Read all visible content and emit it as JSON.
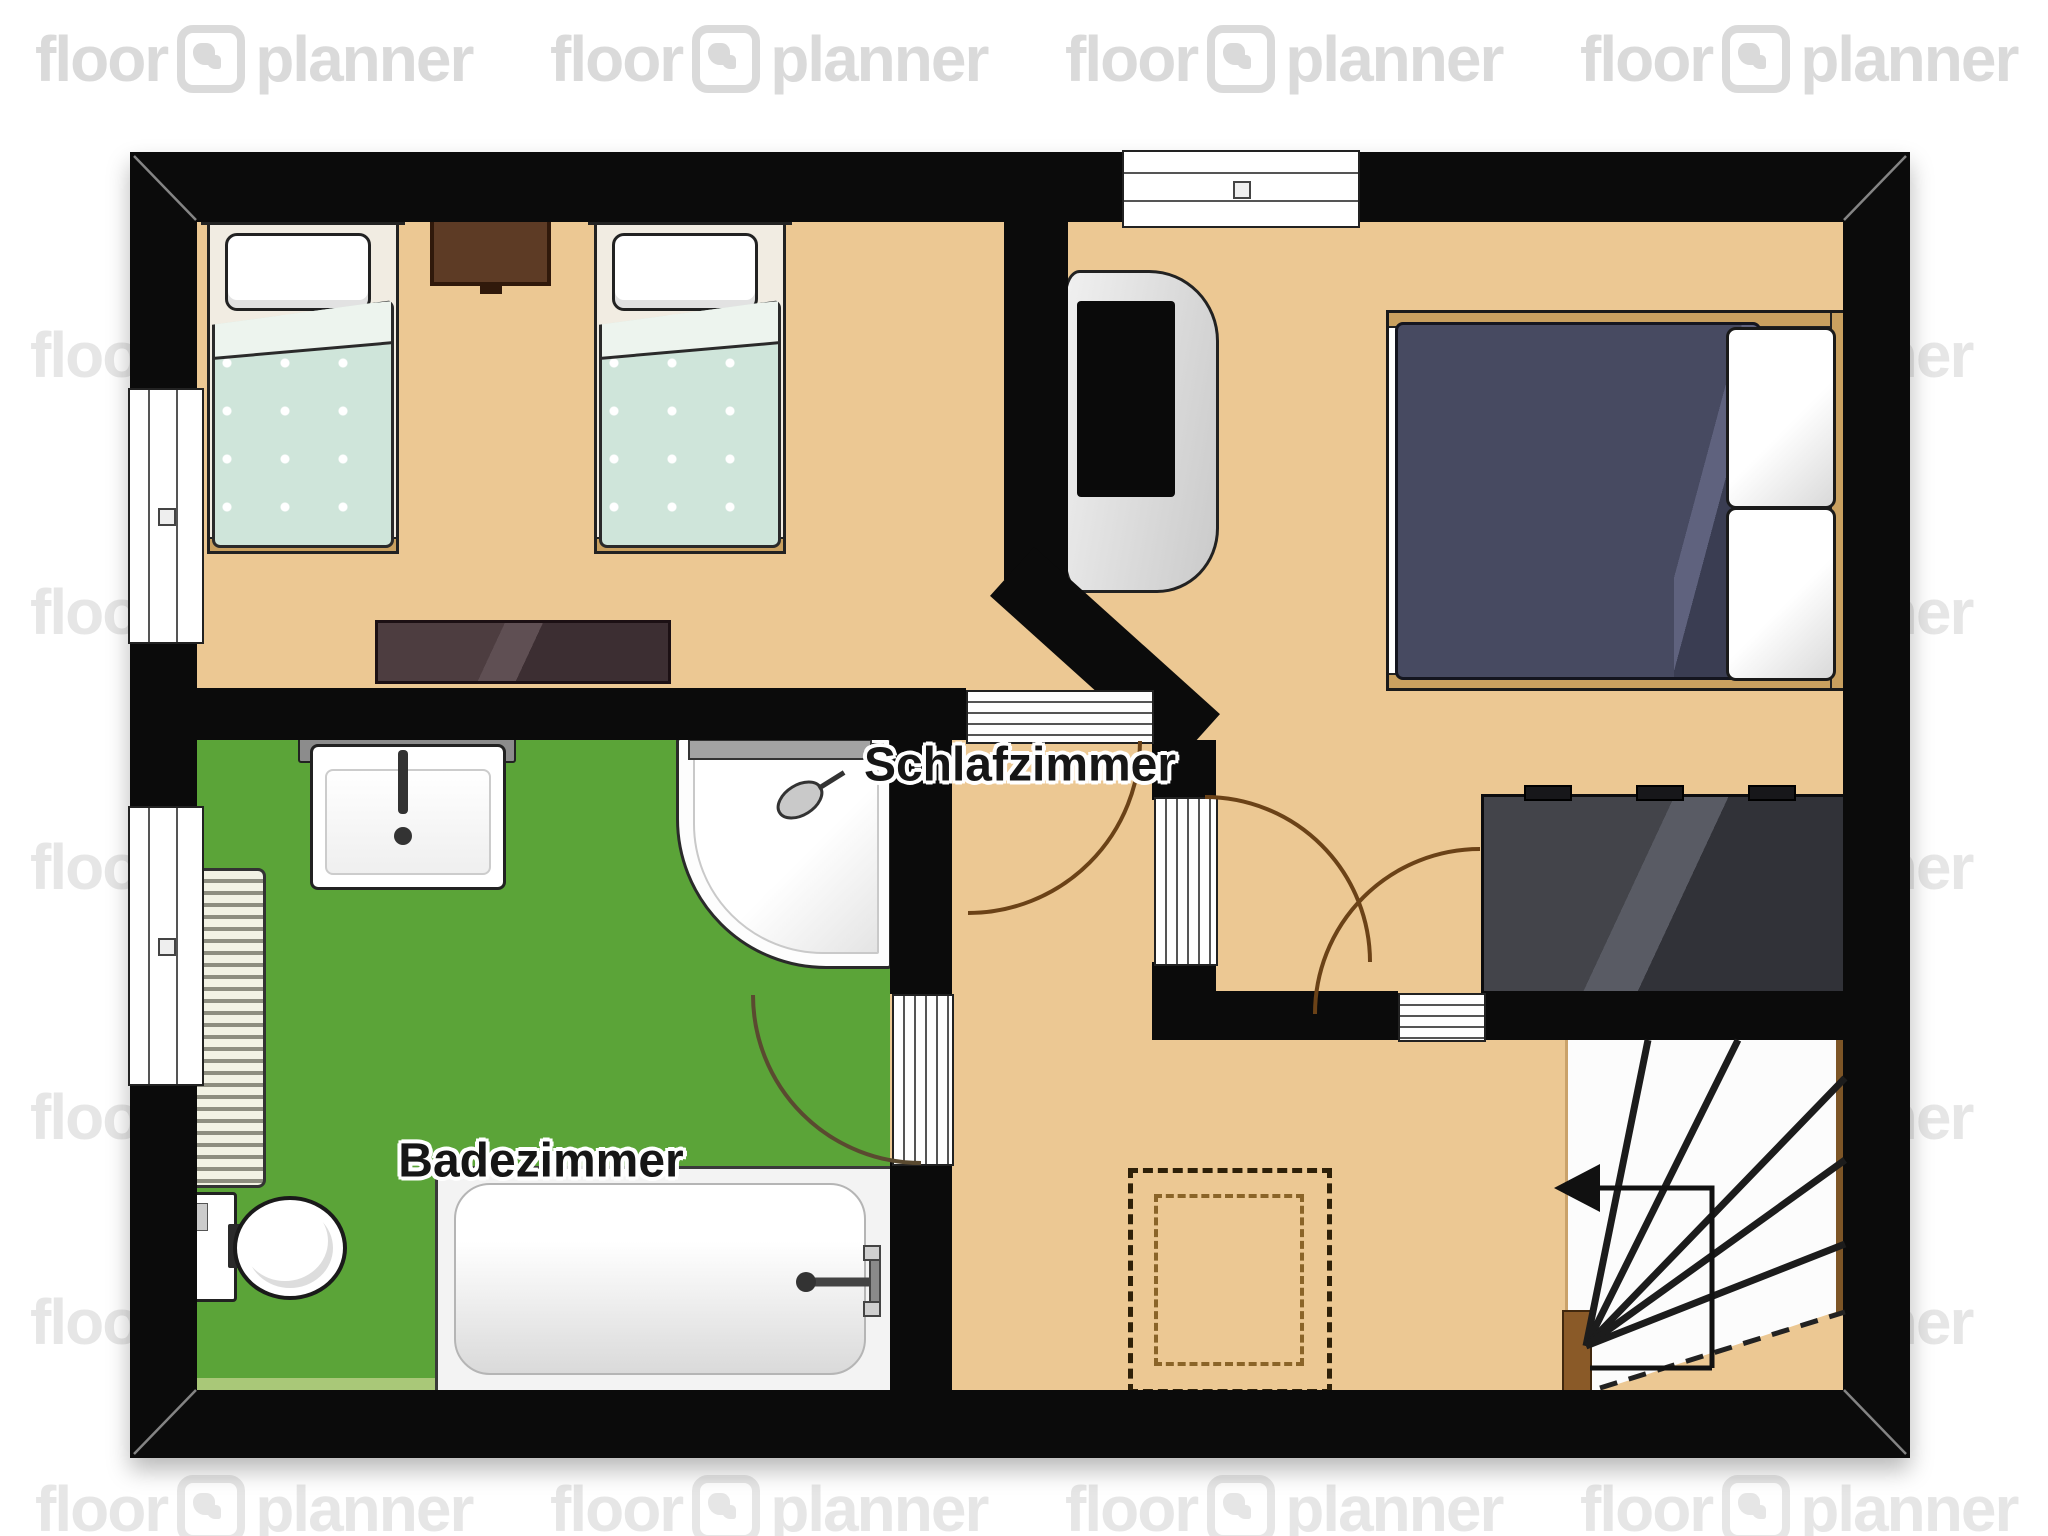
{
  "watermark": {
    "word_left": "floor",
    "word_right": "planner"
  },
  "rooms": [
    {
      "name": "Schlafzimmer"
    },
    {
      "name": "Badezimmer"
    }
  ],
  "icons": {
    "floorplanner_logo": "rounded-square-house-icon",
    "stairs_direction_arrow": "◀"
  },
  "colors": {
    "wall": "#0b0b0b",
    "floor": "#ecc893",
    "bathroom_floor": "#5ba438",
    "kids_blanket": "#cfe5da",
    "double_bed_duvet": "#474a61",
    "bed_wood": "#c9a05f",
    "nightstand": "#5d3b25",
    "sideboard": "#4a393b",
    "dresser": "#393a40",
    "door_arc": "#6b4217",
    "void_marker_dashed": "#2e2008",
    "watermark_gray": "#d2d2d2"
  }
}
